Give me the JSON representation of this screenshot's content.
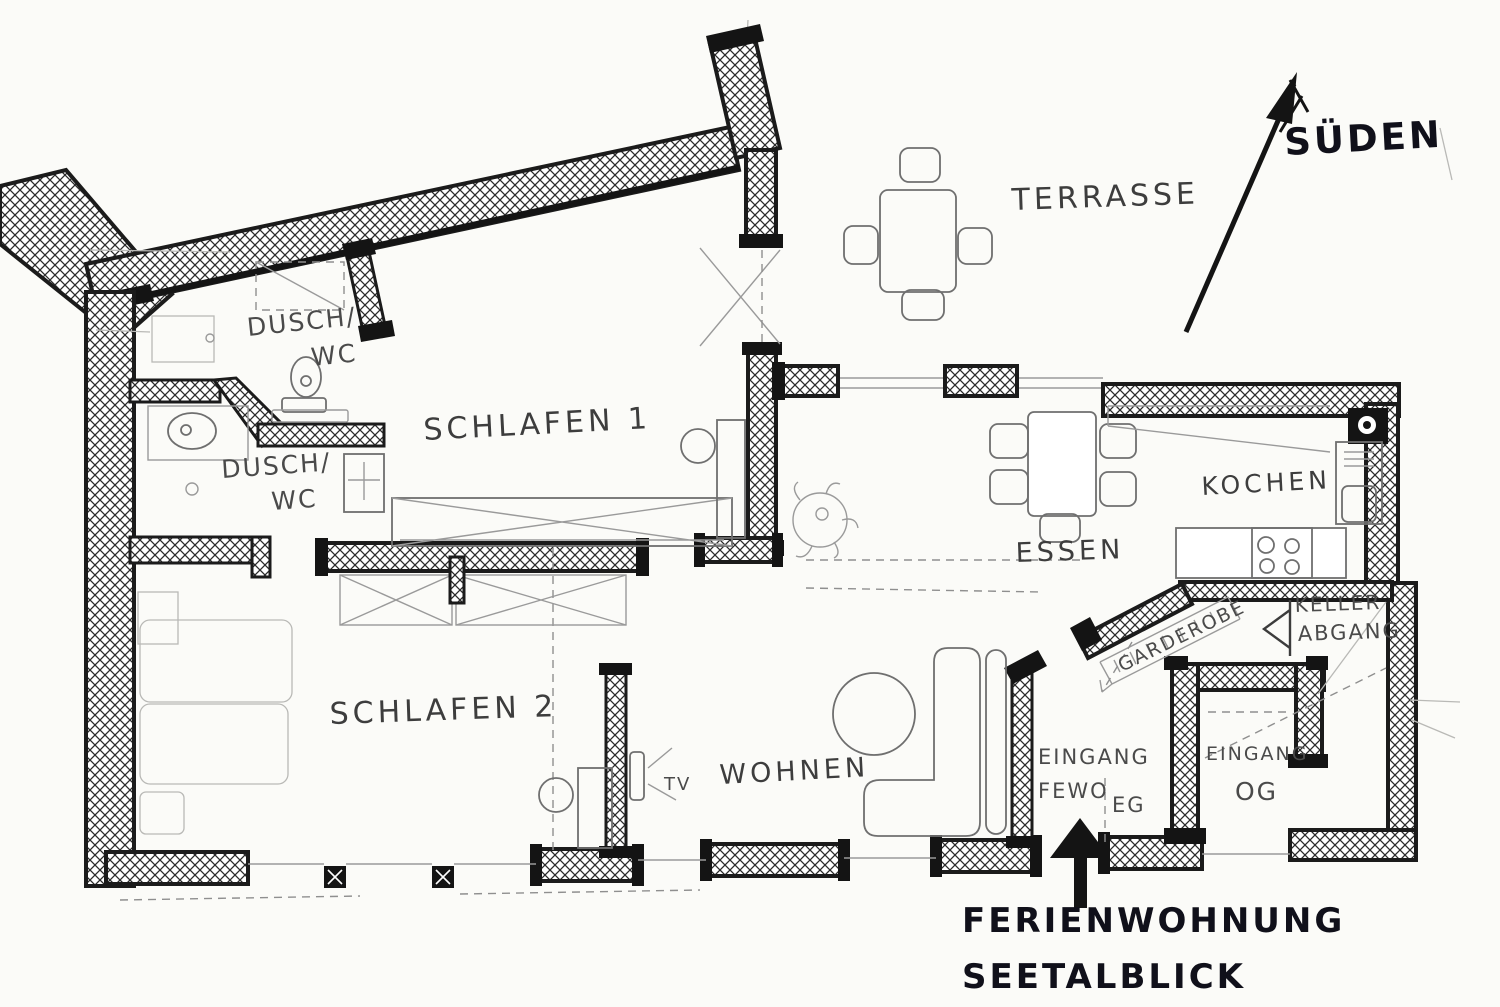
{
  "colors": {
    "ink": "#1b1b1b",
    "sketch_gray": "#6f6f6f",
    "paper": "#fbfbf8"
  },
  "compass": {
    "south_label": "SÜDEN"
  },
  "outdoor": {
    "terrace": "TERRASSE"
  },
  "rooms": {
    "bath1": {
      "l1": "DUSCH/",
      "l2": "WC"
    },
    "bath2": {
      "l1": "DUSCH/",
      "l2": "WC"
    },
    "bedroom1": "SCHLAFEN 1",
    "bedroom2": "SCHLAFEN 2",
    "living": "WOHNEN",
    "dining": "ESSEN",
    "kitchen": "KOCHEN",
    "wardrobe": "GARDEROBE",
    "cellar": {
      "l1": "KELLER",
      "l2": "ABGANG"
    },
    "entrance_apartment": {
      "l1": "EINGANG",
      "l2": "FEWO",
      "l3": "EG"
    },
    "entrance_upper": {
      "l1": "EINGANG",
      "l2": "OG"
    },
    "tv": "TV"
  },
  "title": {
    "l1": "FERIENWOHNUNG",
    "l2": "SEETALBLICK"
  }
}
